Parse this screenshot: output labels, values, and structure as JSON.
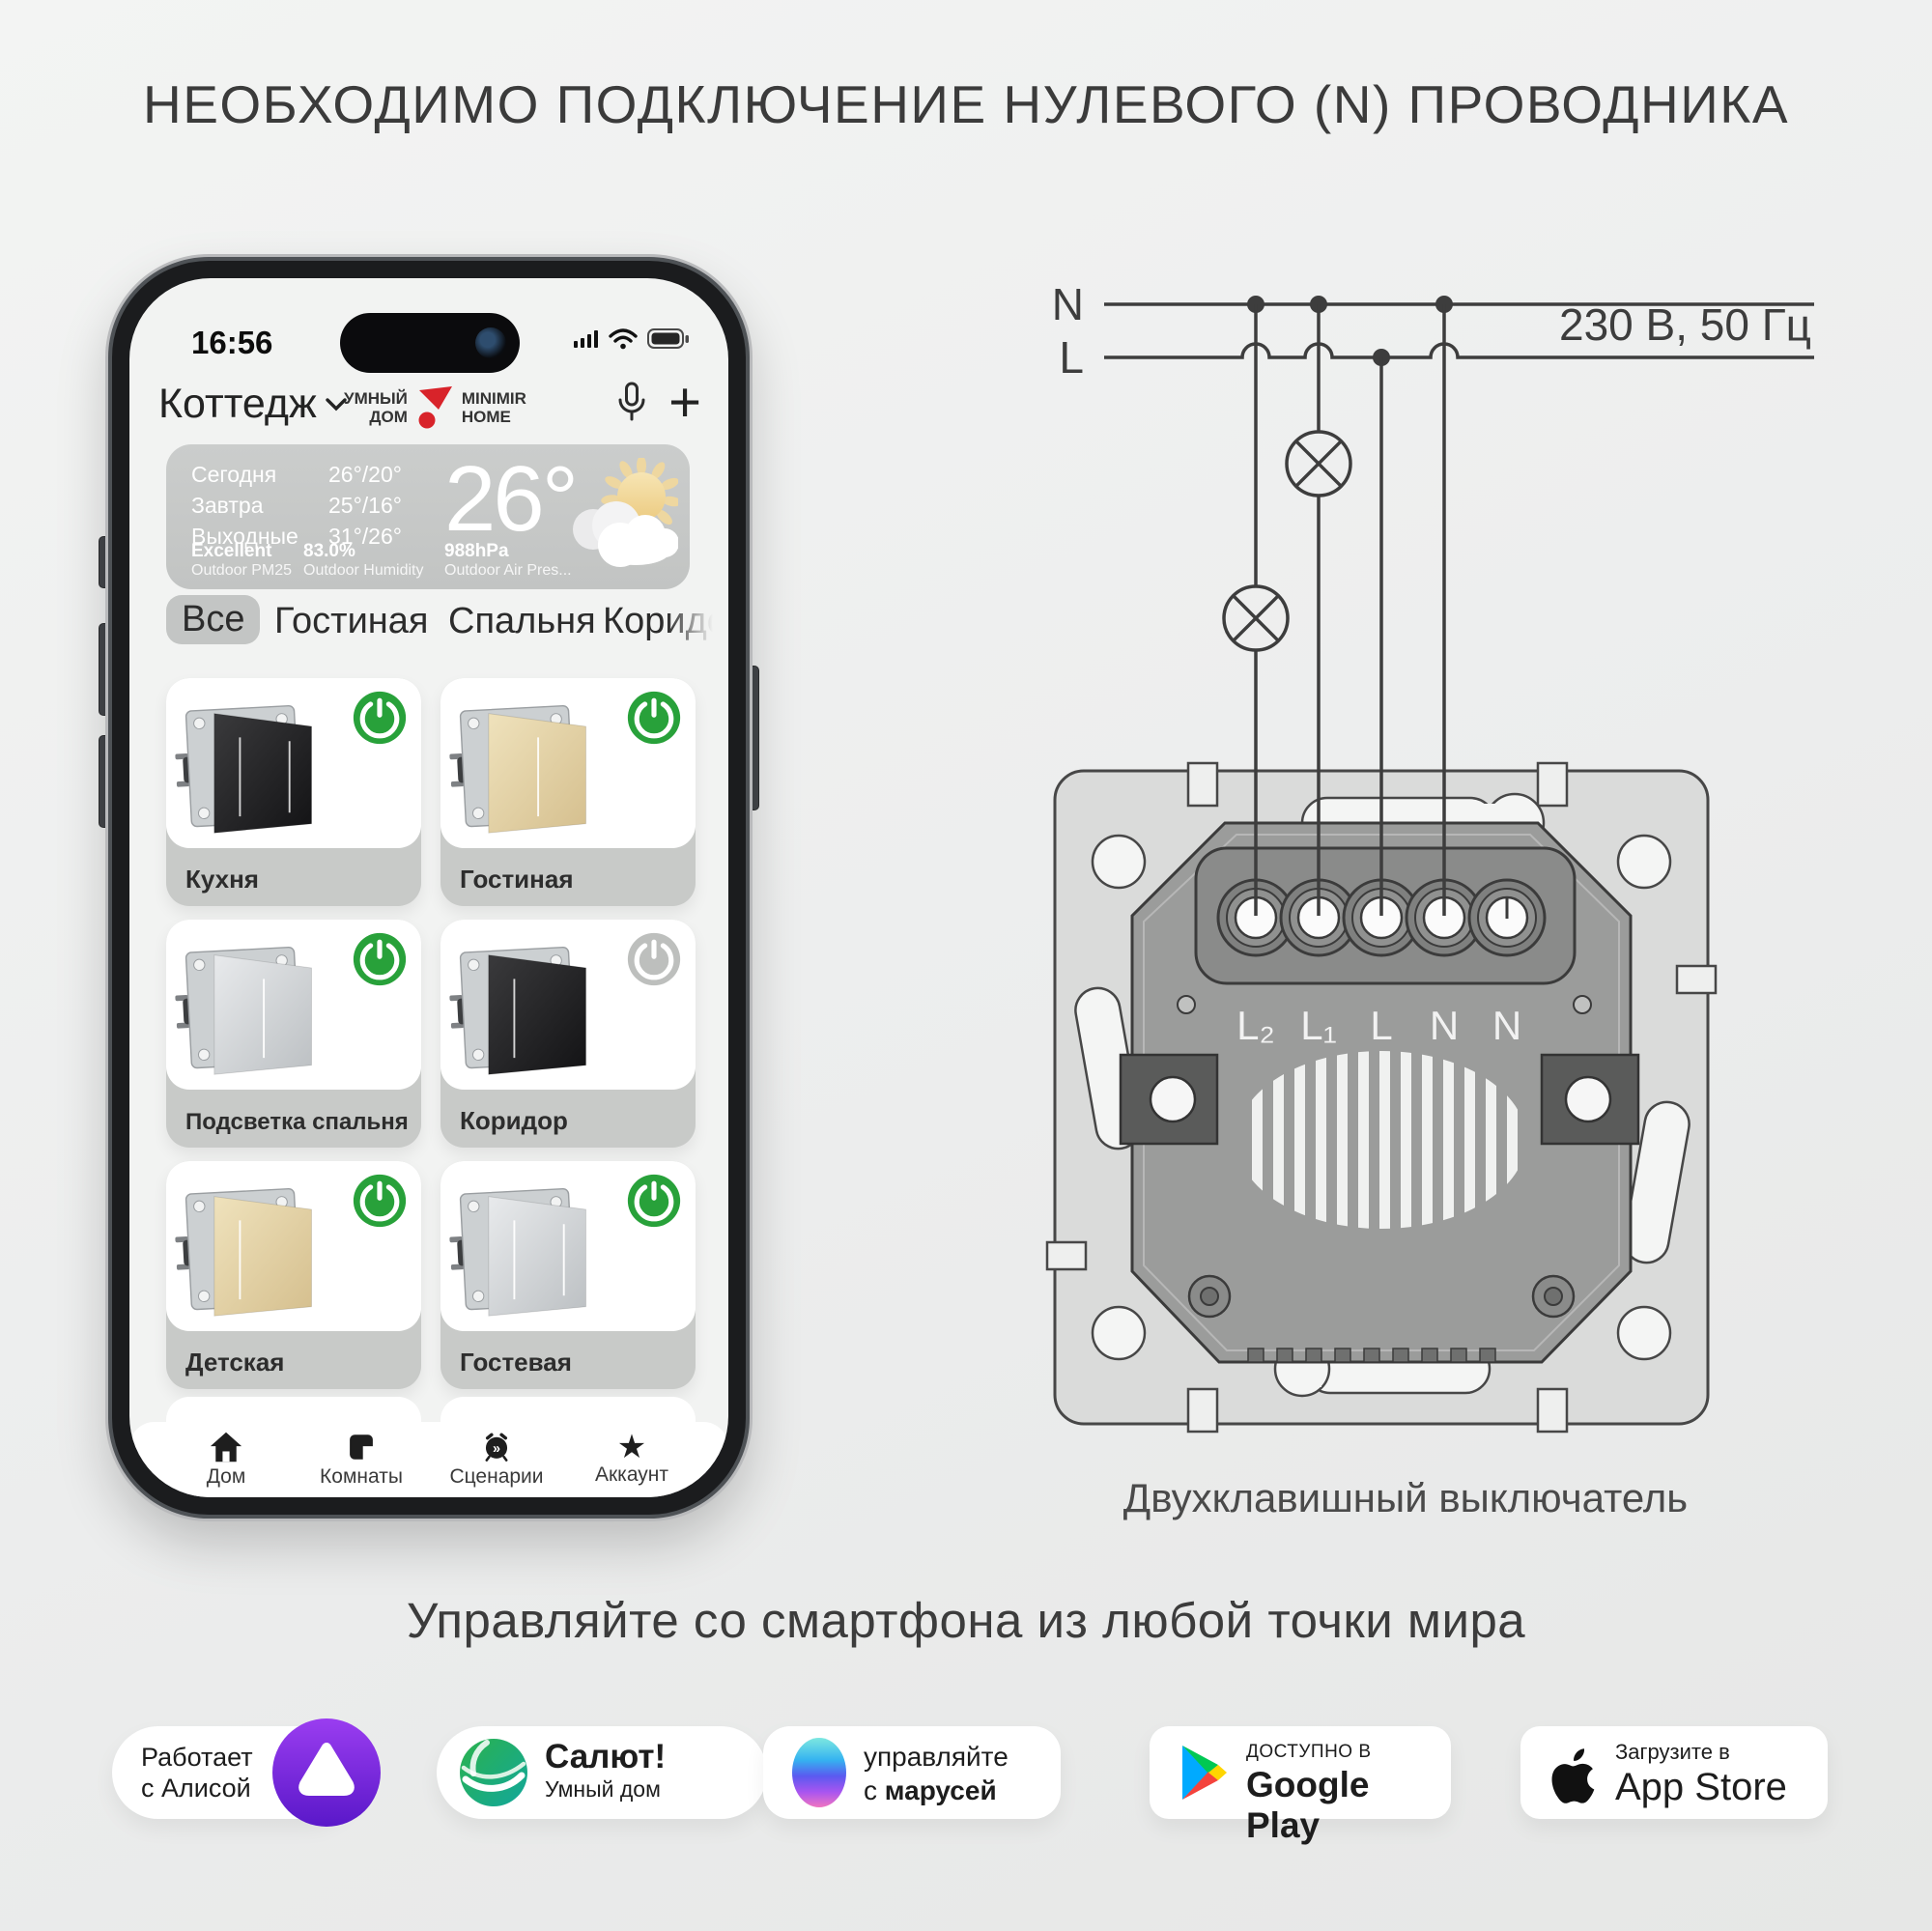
{
  "title": "НЕОБХОДИМО ПОДКЛЮЧЕНИЕ НУЛЕВОГО (N) ПРОВОДНИКА",
  "subtitle": "Управляйте со смартфона из любой точки мира",
  "phone": {
    "time": "16:56",
    "header": {
      "home": "Коттедж",
      "brand_left1": "УМНЫЙ",
      "brand_left2": "ДОМ",
      "brand_right1": "MINIMIR",
      "brand_right2": "HOME"
    },
    "weather": {
      "rows": [
        {
          "label": "Сегодня",
          "temps": "26°/20°"
        },
        {
          "label": "Завтра",
          "temps": "25°/16°"
        },
        {
          "label": "Выходные",
          "temps": "31°/26°"
        }
      ],
      "big": "26°",
      "metrics": [
        {
          "value": "Excellent",
          "label": "Outdoor PM25"
        },
        {
          "value": "83.0%",
          "label": "Outdoor Humidity"
        },
        {
          "value": "988hPa",
          "label": "Outdoor Air Pres..."
        }
      ]
    },
    "tabs": [
      "Все",
      "Гостиная",
      "Спальня",
      "Коридор"
    ],
    "devices": [
      {
        "name": "Кухня",
        "on": true
      },
      {
        "name": "Гостиная",
        "on": true
      },
      {
        "name": "Подсветка спальня",
        "on": true
      },
      {
        "name": "Коридор",
        "on": false
      },
      {
        "name": "Детская",
        "on": true
      },
      {
        "name": "Гостевая",
        "on": true
      }
    ],
    "nav": [
      "Дом",
      "Комнаты",
      "Сценарии",
      "Аккаунт"
    ]
  },
  "diagram": {
    "n_label": "N",
    "l_label": "L",
    "voltage": "230 В, 50 Гц",
    "terminals": [
      "L₂",
      "L₁",
      "L",
      "N",
      "N"
    ],
    "caption": "Двухклавишный выключатель"
  },
  "badges": {
    "alice": {
      "line1": "Работает",
      "line2": "с Алисой"
    },
    "salut": {
      "title": "Салют!",
      "subtitle": "Умный дом"
    },
    "marusia": {
      "line1": "управляйте",
      "line2_prefix": "с",
      "line2_bold": "марусей"
    },
    "google_play": {
      "small": "ДОСТУПНО В",
      "big": "Google Play"
    },
    "app_store": {
      "small": "Загрузите в",
      "big": "App Store"
    }
  },
  "colors": {
    "power_on": "#28a13a",
    "power_off": "#bdbfbd",
    "brand_red": "#d8232a"
  }
}
